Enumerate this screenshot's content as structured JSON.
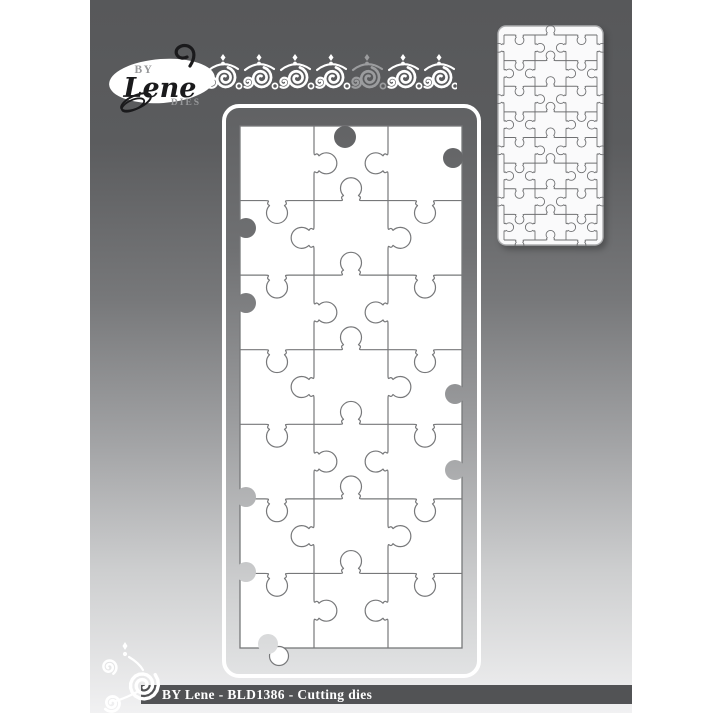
{
  "image": {
    "kind": "product-image",
    "canvas_bg": "#ffffff",
    "background_gradient": [
      "#57585a",
      "#5b5c5e",
      "#77787a",
      "#a2a3a5",
      "#cdcecf",
      "#f1f1f2"
    ]
  },
  "logo": {
    "prefix": "BY",
    "name": "Lene",
    "suffix": "DIES",
    "ellipse_color": "#ffffff",
    "accent_text_color": "#97989a",
    "script_color": "#1a1a1c"
  },
  "ornaments": {
    "top_border": {
      "icon": "scroll-flourish-border",
      "modules": 7,
      "accent_module_index": 4,
      "color": "#ffffff",
      "accent_color": "#9b9c9e"
    },
    "footer_flourish": {
      "icon": "corner-swirl-flourish",
      "color": "#ffffff"
    }
  },
  "main_die": {
    "label": "Puzzle cutting die - front view",
    "cols": 3,
    "rows": 7,
    "frame_gradient": [
      "#606163",
      "#6f7072",
      "#9b9c9e",
      "#cfd0d1",
      "#e2e3e4"
    ],
    "frame_stroke": "#ffffff",
    "line_color": "#77787a",
    "piece_fill": "#ffffff",
    "sockets": [
      {
        "edge": "top",
        "cx": 123,
        "cy": 33,
        "r": 11
      },
      {
        "edge": "right",
        "cx": 231,
        "cy": 54,
        "r": 10
      },
      {
        "edge": "left",
        "cx": 24,
        "cy": 124,
        "r": 10
      },
      {
        "edge": "left",
        "cx": 24,
        "cy": 199,
        "r": 10
      },
      {
        "edge": "right",
        "cx": 233,
        "cy": 290,
        "r": 10
      },
      {
        "edge": "right",
        "cx": 233,
        "cy": 366,
        "r": 10
      },
      {
        "edge": "left",
        "cx": 24,
        "cy": 393,
        "r": 10
      },
      {
        "edge": "left",
        "cx": 24,
        "cy": 468,
        "r": 10
      },
      {
        "edge": "bottom",
        "cx": 46,
        "cy": 540,
        "r": 10
      }
    ],
    "edge_knob": {
      "edge": "bottom",
      "cx": 57,
      "cy": 552,
      "r": 9.5
    }
  },
  "preview_die": {
    "label": "Die preview thumbnail",
    "cols": 3,
    "rows": 8,
    "card_fill": "#fafafb",
    "card_stroke": "#adaeb0",
    "line_color": "#6f7072"
  },
  "footer": {
    "caption": "BY Lene - BLD1386 - Cutting dies",
    "bar_color": "#525355",
    "text_color": "#ffffff"
  }
}
